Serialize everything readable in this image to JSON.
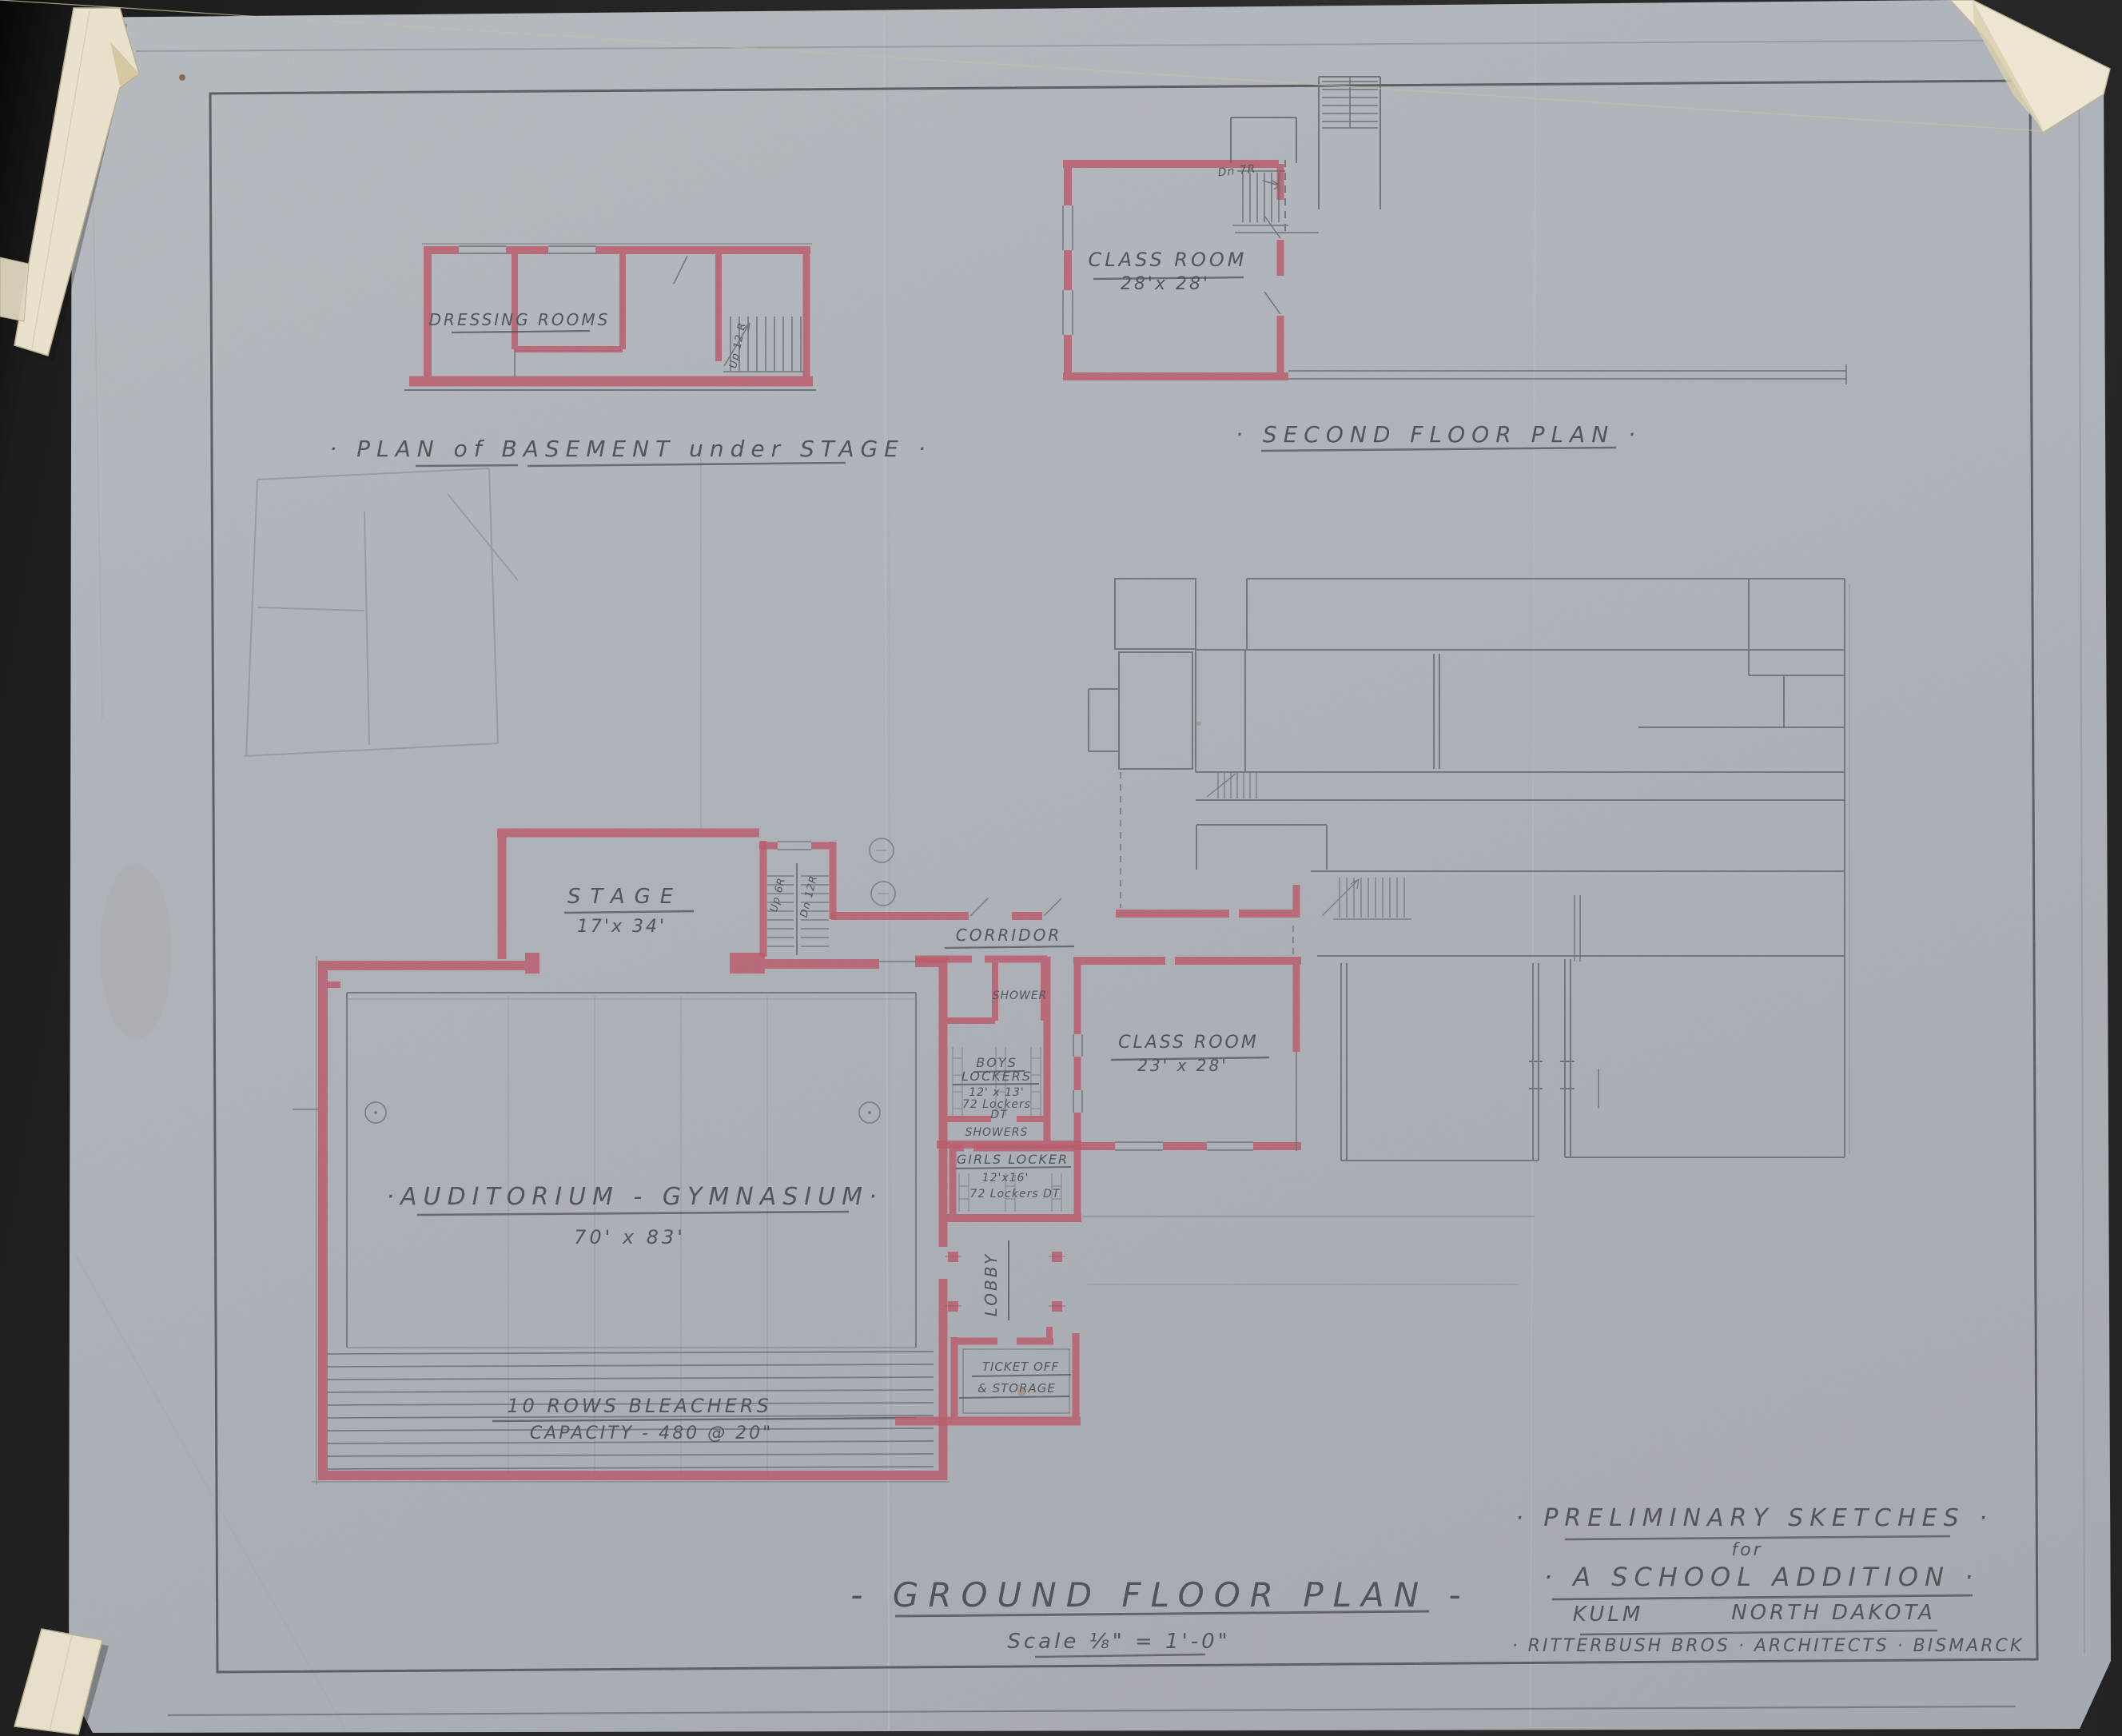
{
  "sheet": {
    "basement_plan": {
      "caption": "· PLAN of BASEMENT under STAGE ·",
      "dressing_rooms_label": "DRESSING ROOMS",
      "stairs_label": "Up 12 R"
    },
    "second_floor_plan": {
      "caption": "· SECOND FLOOR PLAN ·",
      "classroom_label": "CLASS ROOM",
      "classroom_size": "28'x 28'",
      "stairs_label": "Dn 7R"
    },
    "ground_floor_plan": {
      "caption": "- GROUND FLOOR PLAN -",
      "scale_note": "Scale ⅛\" = 1'-0\"",
      "stage_label": "STAGE",
      "stage_size": "17'x 34'",
      "stage_stairs_up": "Up 6R",
      "stage_stairs_down": "Dn 12R",
      "corridor_label": "CORRIDOR",
      "shower_label": "SHOWER",
      "boys_line1": "BOYS",
      "boys_line2": "LOCKERS",
      "boys_size": "12' x 13'",
      "boys_note1": "72 Lockers",
      "boys_note2": "DT",
      "showers_label": "SHOWERS",
      "classroom_label": "CLASS ROOM",
      "classroom_size": "23' x 28'",
      "girls_label": "GIRLS LOCKER",
      "girls_size": "12'x16'",
      "girls_note": "72 Lockers DT",
      "lobby_label": "LOBBY",
      "ticket_line1": "TICKET OFF",
      "ticket_line2": "& STORAGE",
      "auditorium_label": "·AUDITORIUM - GYMNASIUM·",
      "auditorium_size": "70' x 83'",
      "bleachers_line1": "10 ROWS BLEACHERS",
      "bleachers_line2": "CAPACITY - 480 @ 20\""
    },
    "title_block": {
      "line1": "· PRELIMINARY SKETCHES ·",
      "line2": "for",
      "line3": "· A SCHOOL ADDITION ·",
      "city": "KULM",
      "state": "NORTH DAKOTA",
      "firm": "· RITTERBUSH BROS · ARCHITECTS · BISMARCK"
    },
    "colors": {
      "paper": "#b6bac0",
      "backing": "#262626",
      "ink_red": "#c5495c",
      "pencil": "#53565b",
      "tape": "#e8e2cd"
    }
  }
}
